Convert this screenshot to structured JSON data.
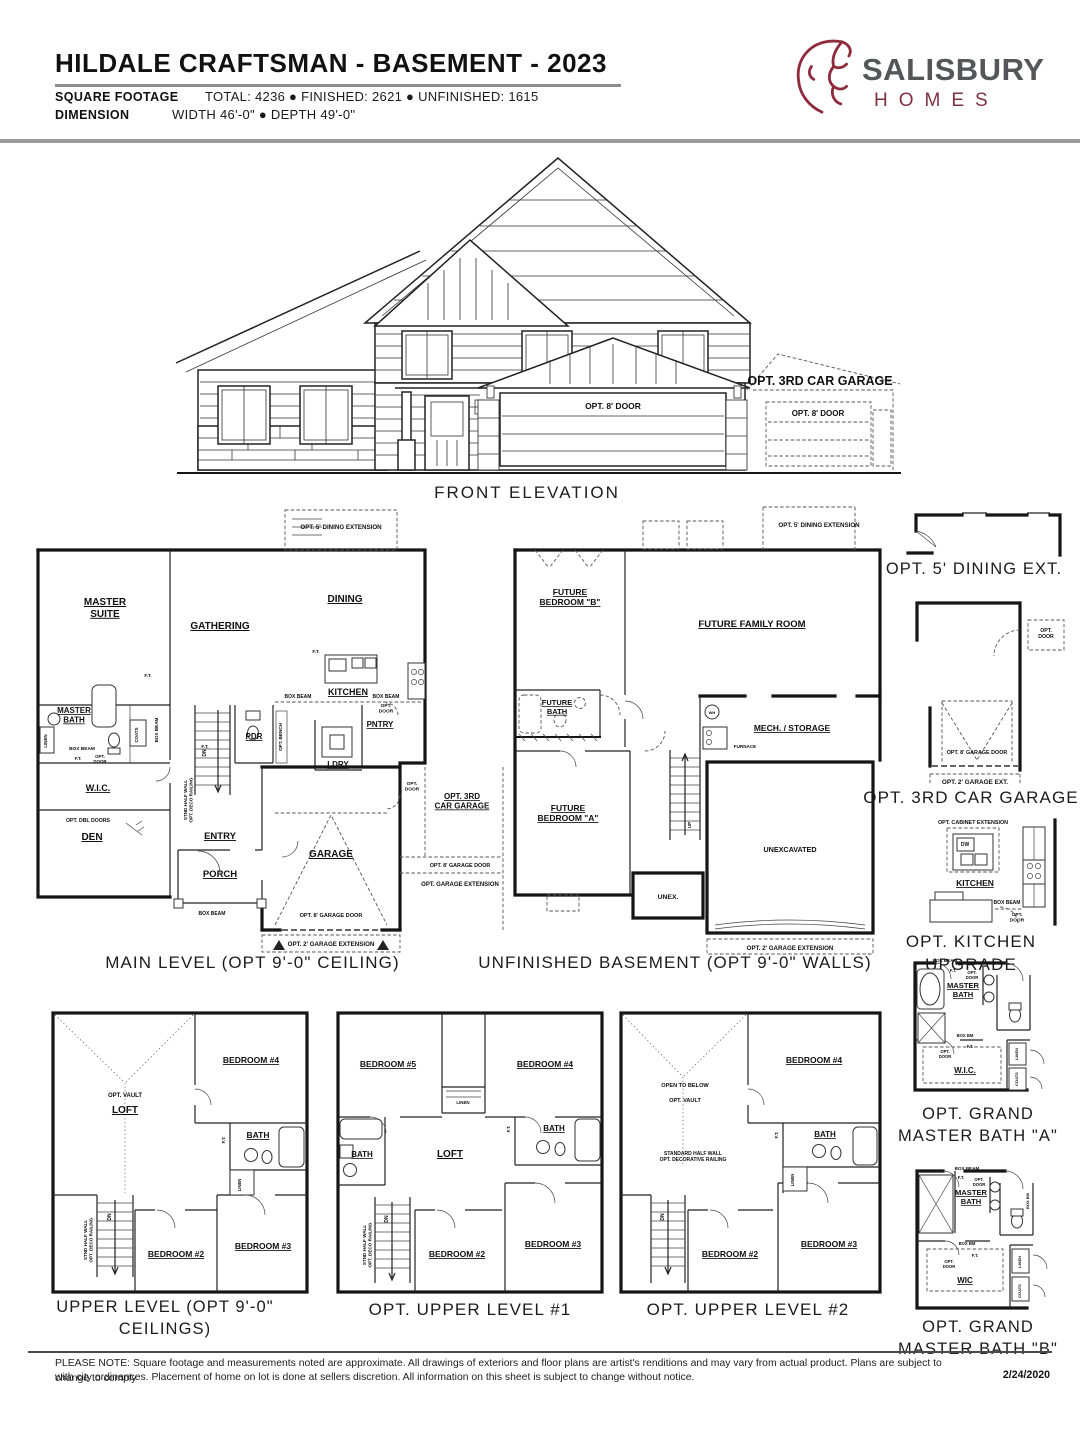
{
  "header": {
    "title": "HILDALE CRAFTSMAN - BASEMENT - 2023",
    "sqft_label": "SQUARE FOOTAGE",
    "sqft_value": "TOTAL: 4236  ●  FINISHED: 2621  ●  UNFINISHED:  1615",
    "dim_label": "DIMENSION",
    "dim_value": "WIDTH 46'-0\"  ●  DEPTH 49'-0\""
  },
  "logo": {
    "brand": "SALISBURY",
    "word": "HOMES"
  },
  "elevation": {
    "caption": "FRONT ELEVATION",
    "opt_3rd": "OPT. 3RD CAR GARAGE",
    "opt_door8": "OPT. 8' DOOR"
  },
  "common": {
    "box_beam": "BOX BEAM",
    "box_bm": "BOX BM",
    "ft": "F.T.",
    "opt_door2": "OPT.\nDOOR",
    "opt_door": "OPT. DOOR",
    "linen": "LINEN",
    "coats": "COATS",
    "dn": "DN",
    "up": "UP",
    "dw": "DW",
    "wh": "WH",
    "bath": "BATH",
    "loft": "LOFT",
    "kitchen": "KITCHEN",
    "master_bath": "MASTER\nBATH",
    "bed2": "BEDROOM #2",
    "bed3": "BEDROOM #3",
    "bed4": "BEDROOM #4",
    "bed5": "BEDROOM #5",
    "dining_ext": "OPT. 5' DINING EXTENSION",
    "g8": "OPT. 8' GARAGE DOOR",
    "gx2": "OPT. 2' GARAGE EXTENSION",
    "gx": "OPT. GARAGE EXTENSION",
    "vault": "OPT. VAULT",
    "otb": "OPEN TO BELOW",
    "hw": "STND HALF WALL\nOPT. DECO RAILING",
    "hw2": "STANDARD HALF WALL\nOPT. DECORATIVE RAILING",
    "furnace": "FURNACE"
  },
  "main": {
    "caption": "MAIN LEVEL (OPT 9'-0\" CEILING)",
    "master_suite": "MASTER\nSUITE",
    "gathering": "GATHERING",
    "dining": "DINING",
    "pdr": "PDR",
    "ldry": "LDRY",
    "pntry": "PNTRY",
    "wic": "W.I.C.",
    "den": "DEN",
    "entry": "ENTRY",
    "porch": "PORCH",
    "garage": "GARAGE",
    "opt3rd": "OPT. 3RD\nCAR GARAGE",
    "dbl": "OPT. DBL DOORS",
    "bench": "OPT. BENCH"
  },
  "base": {
    "caption": "UNFINISHED BASEMENT (OPT 9'-0\" WALLS)",
    "bedb": "FUTURE\nBEDROOM \"B\"",
    "family": "FUTURE FAMILY ROOM",
    "fbath": "FUTURE\nBATH",
    "mech": "MECH. / STORAGE",
    "beda": "FUTURE\nBEDROOM \"A\"",
    "unexcavated": "UNEXCAVATED",
    "unex": "UNEX."
  },
  "opts": {
    "dining_caption": "OPT. 5' DINING EXT.",
    "garage_caption": "OPT. 3RD CAR GARAGE",
    "gx2s": "OPT. 2' GARAGE EXT.",
    "kitchen_caption": "OPT. KITCHEN UPGRADE",
    "cab": "OPT. CABINET EXTENSION"
  },
  "upper": {
    "caption": "UPPER LEVEL (OPT 9'-0\" CEILINGS)"
  },
  "upper1": {
    "caption": "OPT. UPPER LEVEL #1"
  },
  "upper2": {
    "caption": "OPT. UPPER LEVEL #2"
  },
  "bathA": {
    "caption": "OPT. GRAND\nMASTER BATH \"A\"",
    "wic": "W.I.C."
  },
  "bathB": {
    "caption": "OPT. GRAND\nMASTER BATH \"B\"",
    "wic": "WIC"
  },
  "footer": {
    "line1": "PLEASE NOTE: Square footage and measurements noted are approximate. All drawings of exteriors and floor plans are artist's renditions and may vary from actual product. Plans are subject to change to comply",
    "line2": "with city ordinances. Placement of home on lot is done at sellers discretion. All information on this sheet is subject to change without notice.",
    "date": "2/24/2020"
  }
}
